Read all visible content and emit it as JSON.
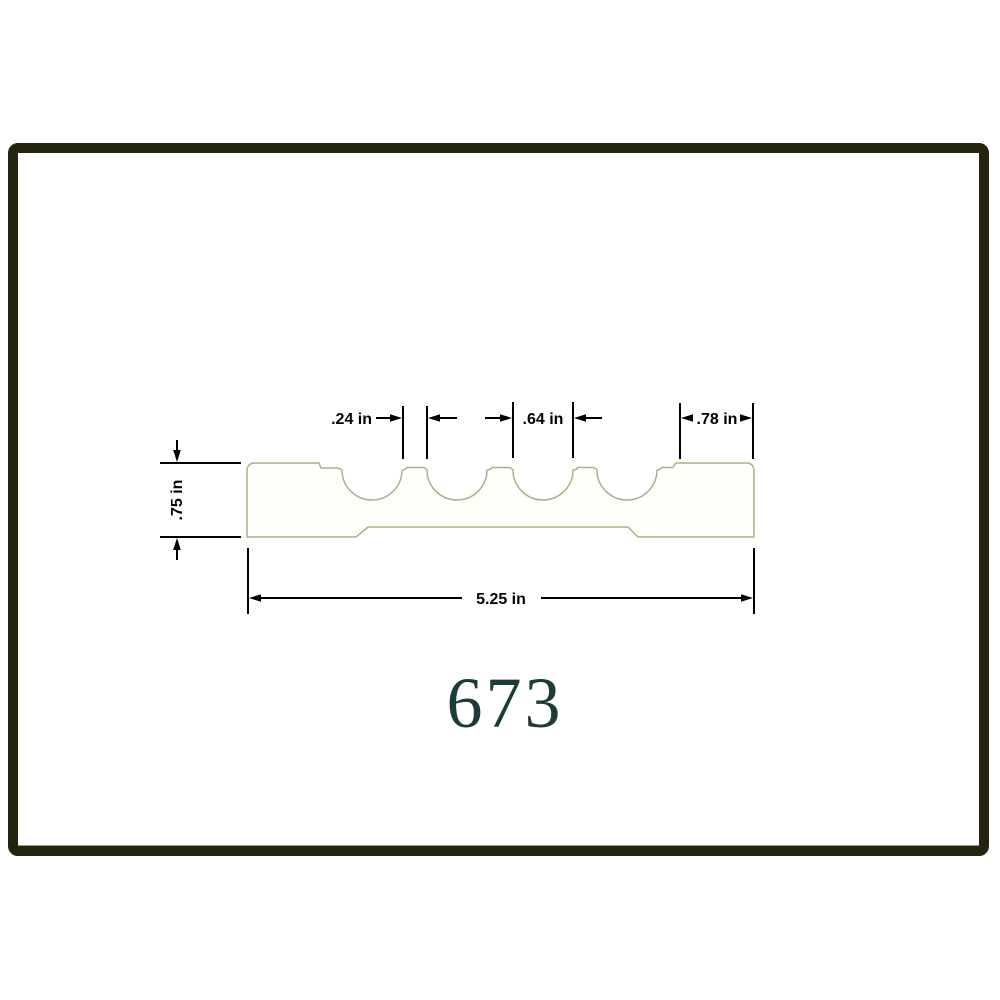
{
  "page": {
    "background_color": "#ffffff"
  },
  "frame": {
    "border_color": "#25250f"
  },
  "drawing": {
    "product_number": "673",
    "product_number_color": "#1d3b38",
    "profile_outline_color": "#aeae8c",
    "dimension_color": "#000000",
    "profile_type": "fluted-molding-cross-section",
    "flute_count": 4,
    "dimensions": {
      "flute_spacing": ".24 in",
      "flute_width": ".64 in",
      "end_flat_width": ".78 in",
      "thickness": ".75 in",
      "overall_width": "5.25 in"
    }
  }
}
